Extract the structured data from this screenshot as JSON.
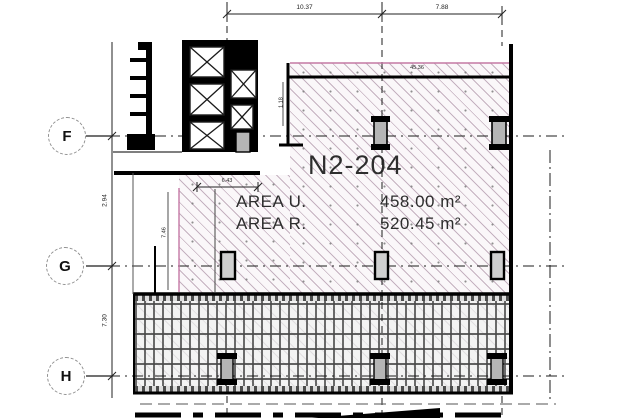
{
  "unit": {
    "label": "N2-204",
    "area_rows": [
      {
        "label": "AREA U.",
        "value": "458.00 m²"
      },
      {
        "label": "AREA R.",
        "value": "520.45 m²"
      }
    ]
  },
  "grid_bubbles": [
    {
      "label": "F"
    },
    {
      "label": "G"
    },
    {
      "label": "H"
    }
  ],
  "dimensions": {
    "top": [
      {
        "value": "10.37"
      },
      {
        "value": "7.88"
      }
    ],
    "left": [
      {
        "value": "2.94"
      },
      {
        "value": "7.30"
      }
    ],
    "interior": [
      {
        "id": "wall-top",
        "value": "45.36"
      },
      {
        "id": "inner-width",
        "value": "6.43"
      },
      {
        "id": "inner-height",
        "value": "7.46"
      },
      {
        "id": "wall-offset",
        "value": "1.18"
      }
    ]
  },
  "colors": {
    "hatch_line": "#c4a8bc",
    "hatch_accent": "#c478a4",
    "wall": "#000000",
    "column_fill": "#b5b5b5",
    "grid_line": "#1c1c1c"
  }
}
